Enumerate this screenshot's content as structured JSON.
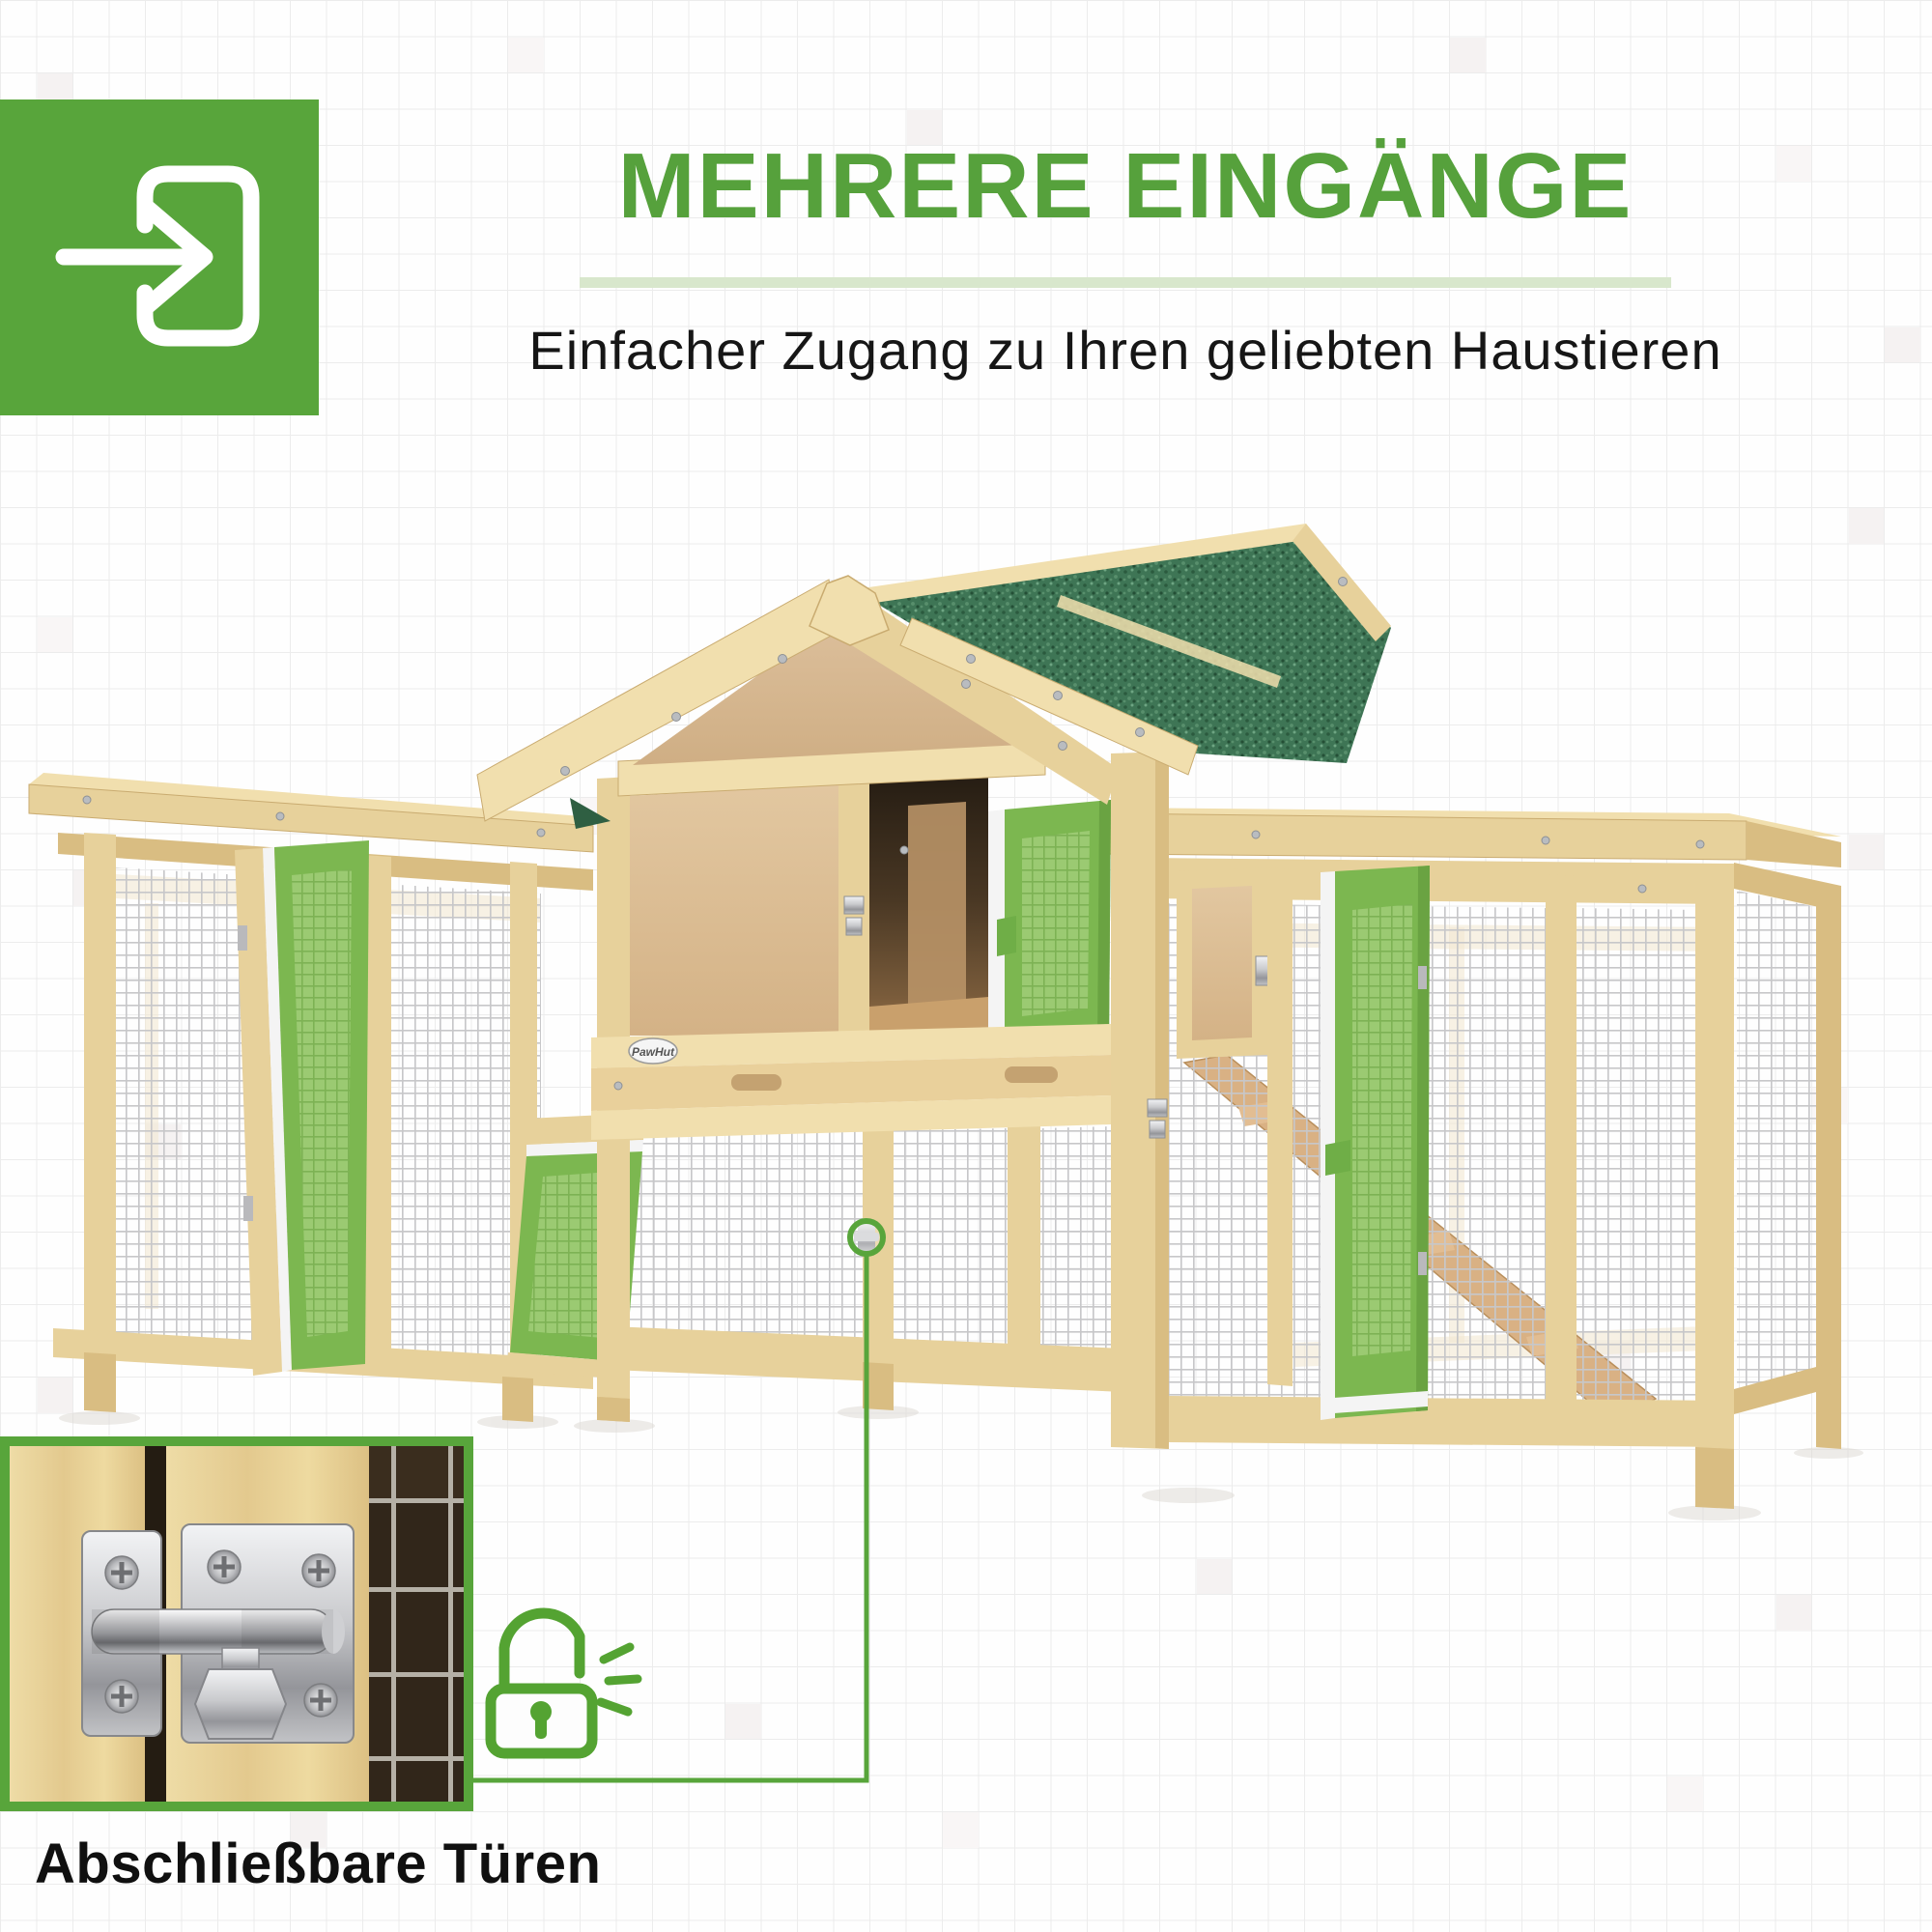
{
  "colors": {
    "brand_green": "#58a53b",
    "title_green": "#56a13c",
    "underline_green": "#d8e7cc",
    "text_dark": "#161616",
    "door_green": "#7cb750",
    "roof_green": "#3e7555",
    "callout_border": "#58a53b",
    "lock_green": "#54a332"
  },
  "background": {
    "shaded_cells": [
      [
        1,
        2,
        0
      ],
      [
        14,
        1,
        1
      ],
      [
        25,
        3,
        0
      ],
      [
        40,
        1,
        0
      ],
      [
        49,
        4,
        1
      ],
      [
        3,
        10,
        0
      ],
      [
        52,
        9,
        0
      ],
      [
        1,
        17,
        1
      ],
      [
        51,
        14,
        0
      ],
      [
        2,
        24,
        0
      ],
      [
        16,
        22,
        1
      ],
      [
        51,
        23,
        0
      ],
      [
        4,
        31,
        0
      ],
      [
        50,
        30,
        1
      ],
      [
        1,
        38,
        0
      ],
      [
        44,
        37,
        0
      ],
      [
        12,
        44,
        1
      ],
      [
        33,
        43,
        0
      ],
      [
        3,
        47,
        0
      ],
      [
        49,
        44,
        0
      ],
      [
        26,
        50,
        1
      ],
      [
        8,
        50,
        0
      ],
      [
        20,
        47,
        0
      ],
      [
        46,
        49,
        1
      ]
    ]
  },
  "header": {
    "icon": "enter-door-arrow-icon",
    "title": "MEHRERE EINGÄNGE",
    "subtitle": "Einfacher Zugang zu Ihren geliebten Haustieren"
  },
  "product": {
    "brand_logo": "PawHut"
  },
  "callout": {
    "caption": "Abschließbare Türen",
    "lock_icon": "open-padlock-icon",
    "marker_icon": "latch-ring-marker"
  }
}
